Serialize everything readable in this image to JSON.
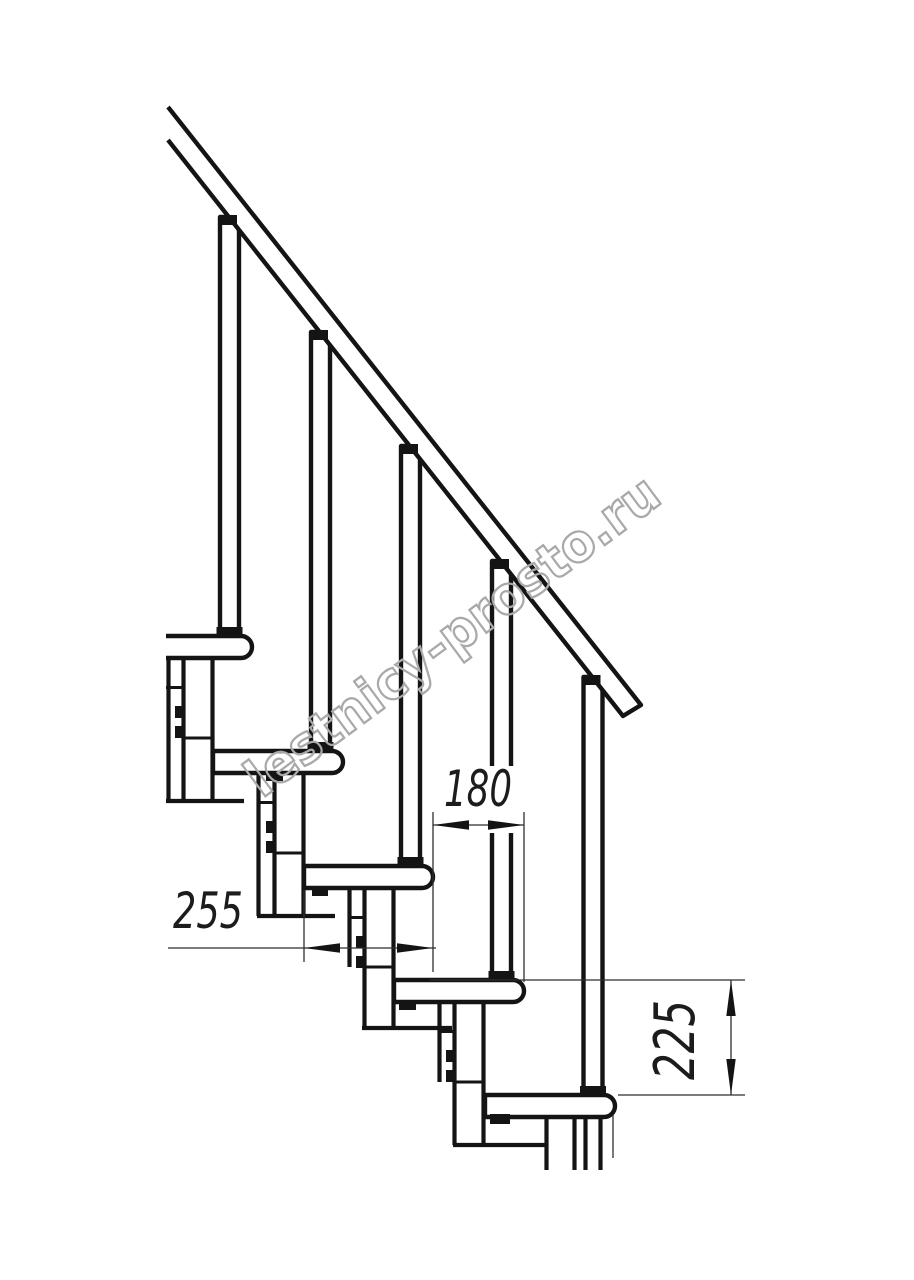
{
  "watermark": {
    "text": "lestnicy-prosto.ru"
  },
  "colors": {
    "line": "#141414",
    "watermark": "#a9a9a9",
    "dim_text": "#1c1c1c"
  },
  "dimensions": {
    "going": "180",
    "tread_depth": "255",
    "rise": "225"
  }
}
